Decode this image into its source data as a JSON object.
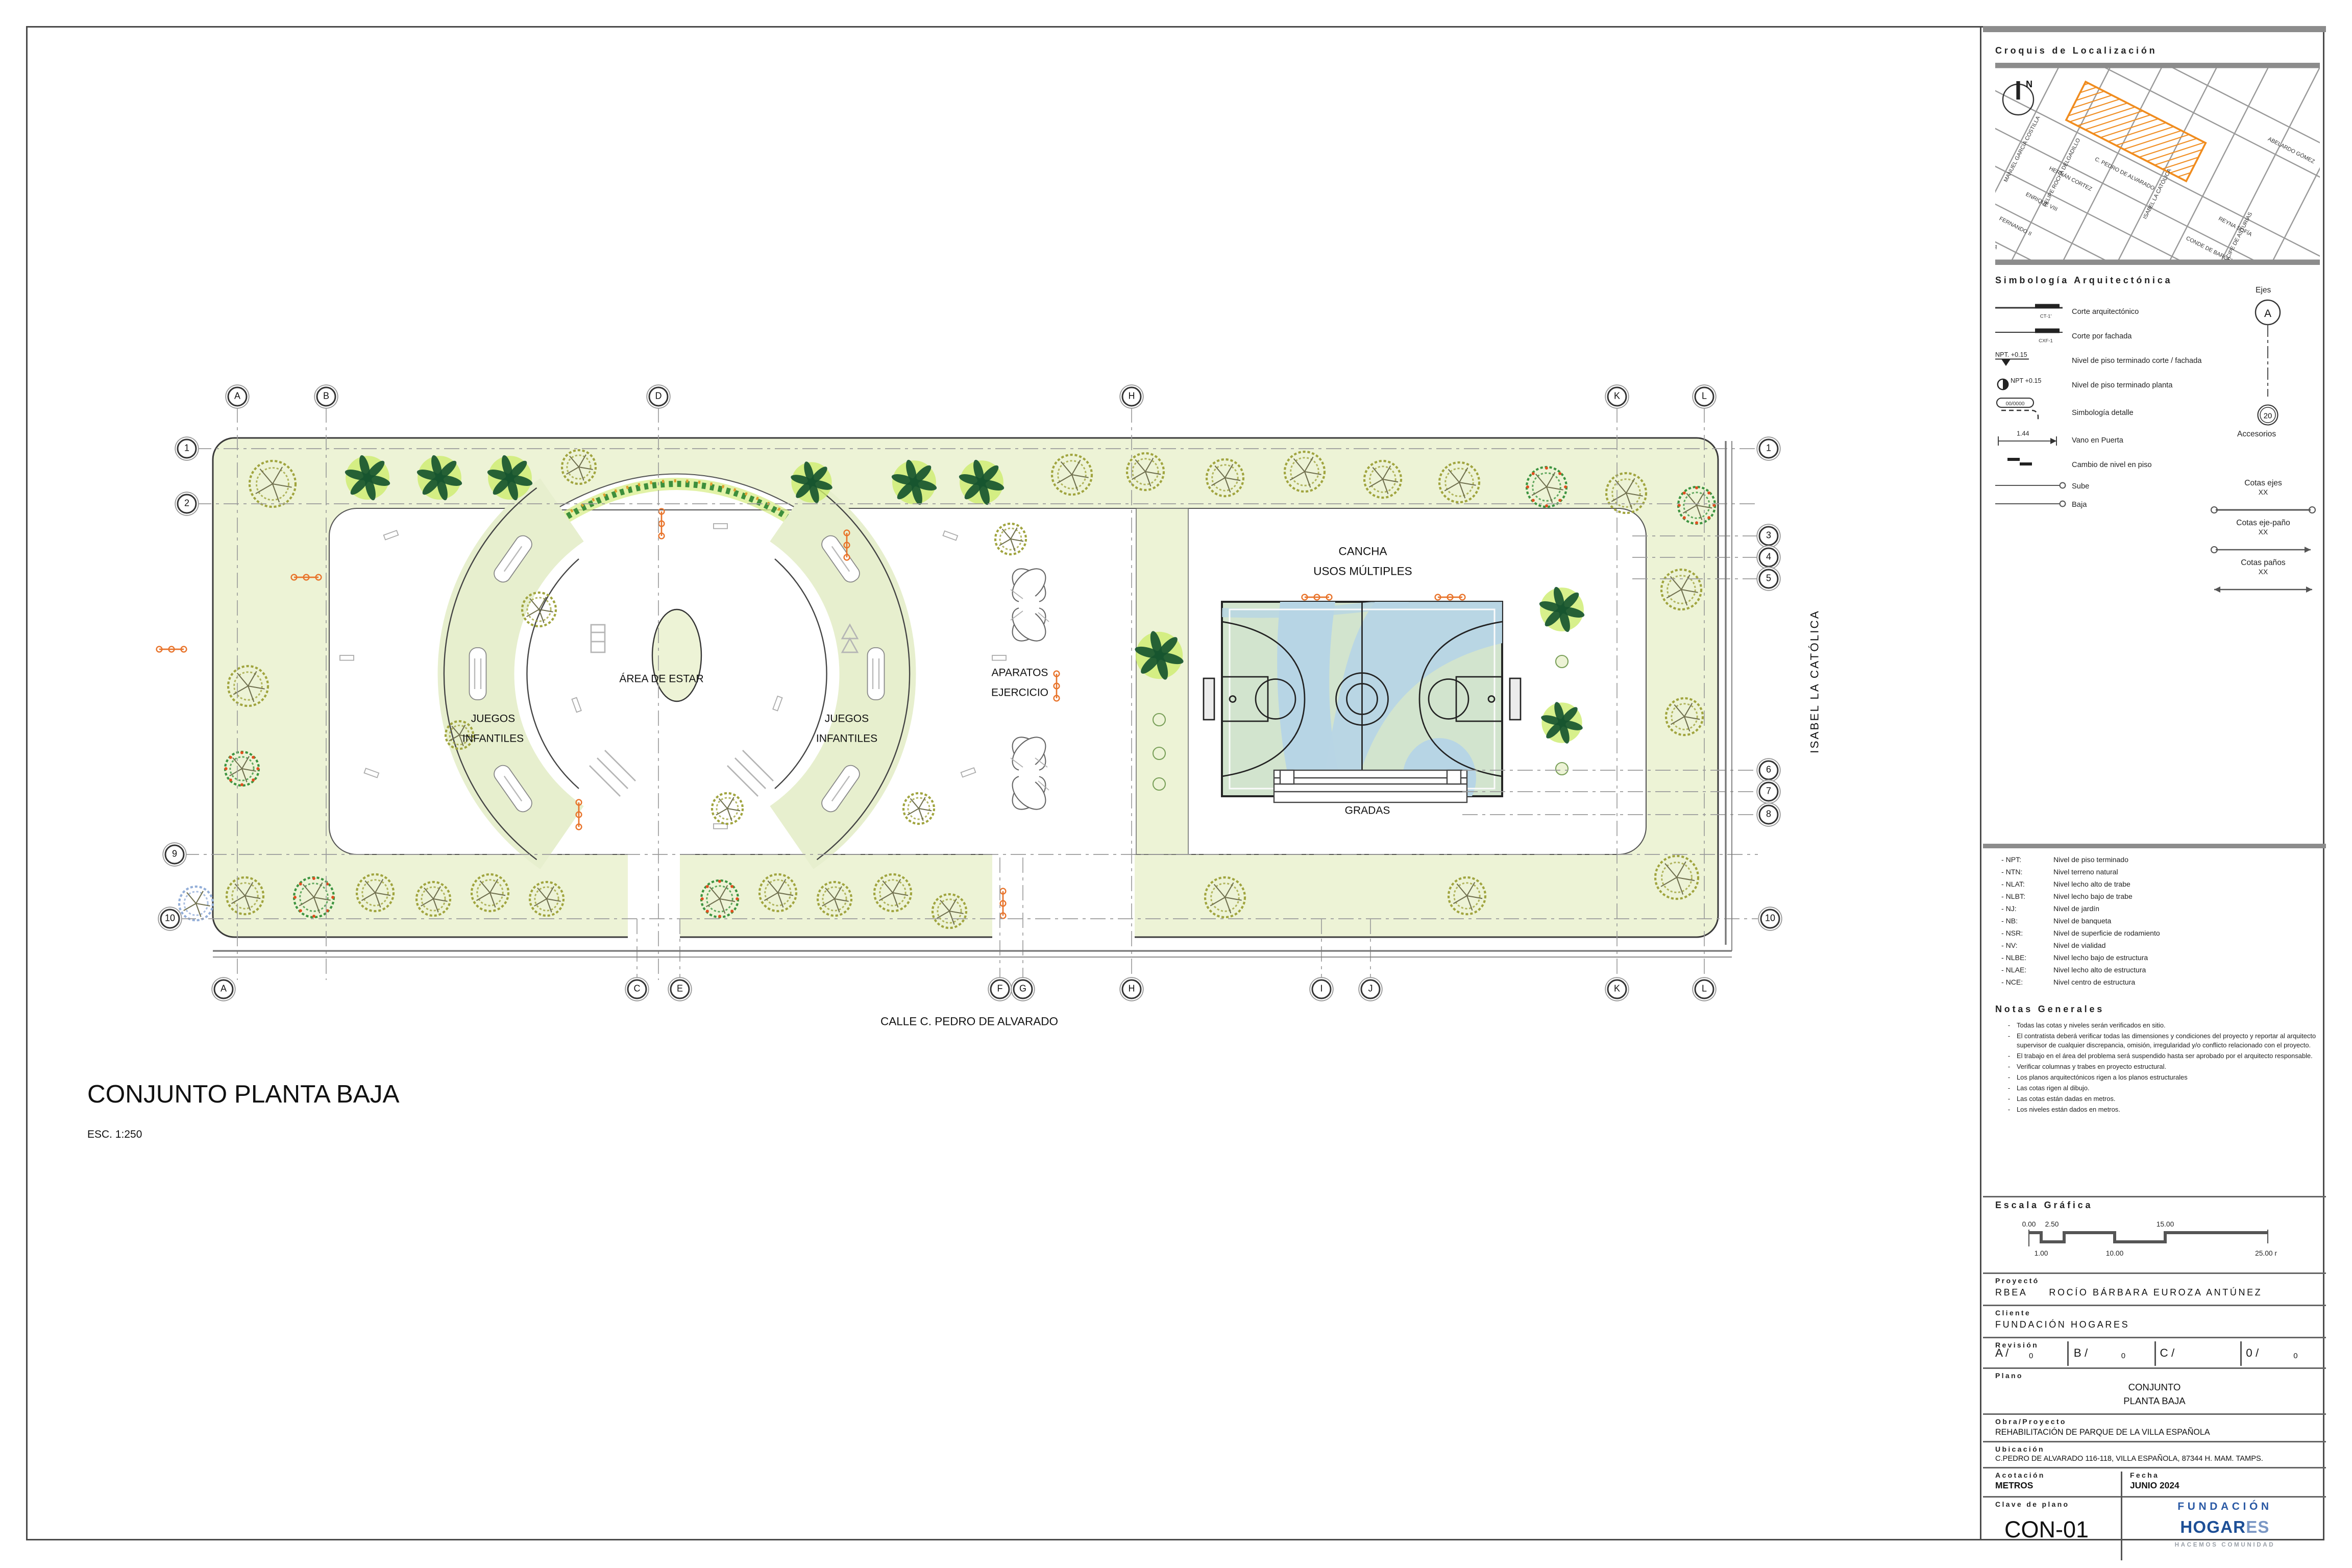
{
  "sheet": {
    "plan_title": "CONJUNTO PLANTA BAJA",
    "plan_scale": "ESC. 1:250",
    "street_bottom": "CALLE C. PEDRO DE ALVARADO",
    "street_right": "ISABEL LA CATÓLICA"
  },
  "plan_labels": {
    "cancha_line1": "CANCHA",
    "cancha_line2": "USOS MÚLTIPLES",
    "area_estar": "ÁREA DE ESTAR",
    "juegos_line1": "JUEGOS",
    "juegos_line2": "INFANTILES",
    "aparatos_line1": "APARATOS",
    "aparatos_line2": "EJERCICIO",
    "gradas": "GRADAS"
  },
  "axes": {
    "top": [
      "A",
      "B",
      "D",
      "H",
      "K",
      "L"
    ],
    "bottom": [
      "A",
      "C",
      "E",
      "F",
      "G",
      "H",
      "I",
      "J",
      "K",
      "L"
    ],
    "left": [
      "1",
      "2",
      "9",
      "10"
    ],
    "right": [
      "1",
      "3",
      "4",
      "5",
      "6",
      "7",
      "8",
      "10"
    ]
  },
  "titleblock": {
    "croquis_title": "Croquis de Localización",
    "north_label": "N",
    "map_streets": [
      "C. PEDRO DE ALVARADO",
      "HERNÁN CORTEZ",
      "ENRIQUE VIII",
      "FERNANDO II",
      "INFANTA ELENA",
      "REYNA SOFÍA",
      "CONDE DE BARCELONA",
      "ABELARDO GÓMEZ",
      "MANUEL GARCÍA COSTILLA",
      "FELIPE ROCHA DELGADILLO",
      "ISABEL LA CATÓLICA",
      "PRÍNCIPE DE ASTURIAS"
    ],
    "simbologia_title": "Simbología Arquitectónica",
    "symbols": [
      {
        "tag": "CT-1'",
        "label": "Corte arquitectónico"
      },
      {
        "tag": "CXF-1",
        "label": "Corte por fachada"
      },
      {
        "tag": "NPT. +0.15",
        "label": "Nivel de piso terminado corte / fachada"
      },
      {
        "tag": "NPT +0.15",
        "label": "Nivel de piso terminado planta"
      },
      {
        "tag": "00/0000",
        "label": "Simbología detalle"
      },
      {
        "tag": "1.44",
        "label": "Vano en Puerta"
      },
      {
        "tag": "",
        "label": "Cambio de nivel en piso"
      },
      {
        "tag": "",
        "label": "Sube"
      },
      {
        "tag": "",
        "label": "Baja"
      }
    ],
    "ejes_title": "Ejes",
    "ejes_bubble": "A",
    "accesorios_bubble": "20",
    "accesorios_label": "Accesorios",
    "cotas": [
      {
        "title": "Cotas ejes",
        "xx": "XX"
      },
      {
        "title": "Cotas eje-paño",
        "xx": "XX"
      },
      {
        "title": "Cotas paños",
        "xx": "XX"
      }
    ],
    "abbreviations": [
      {
        "abbr": "- NPT:",
        "def": "Nivel de piso terminado"
      },
      {
        "abbr": "- NTN:",
        "def": "Nivel terreno natural"
      },
      {
        "abbr": "- NLAT:",
        "def": "Nivel lecho alto de trabe"
      },
      {
        "abbr": "- NLBT:",
        "def": "Nivel lecho bajo de trabe"
      },
      {
        "abbr": "- NJ:",
        "def": "Nivel de jardín"
      },
      {
        "abbr": "- NB:",
        "def": "Nivel de banqueta"
      },
      {
        "abbr": "- NSR:",
        "def": "Nivel de superficie de rodamiento"
      },
      {
        "abbr": "- NV:",
        "def": "Nivel de vialidad"
      },
      {
        "abbr": "- NLBE:",
        "def": "Nivel lecho bajo de estructura"
      },
      {
        "abbr": "- NLAE:",
        "def": "Nivel lecho alto de estructura"
      },
      {
        "abbr": "- NCE:",
        "def": "Nivel centro de estructura"
      }
    ],
    "notas_title": "Notas Generales",
    "notas": [
      "Todas las cotas y niveles serán verificados en sitio.",
      "El contratista deberá verificar todas las dimensiones  y condiciones del proyecto y reportar al arquitecto supervisor de cualquier discrepancia, omisión, irregularidad y/o conflicto relacionado con el proyecto.",
      "El trabajo en el  área del problema será suspendido hasta ser aprobado por el arquitecto responsable.",
      "Verificar columnas y trabes en proyecto estructural.",
      "Los planos arquitectónicos rigen a los planos estructurales",
      "Las cotas rigen al dibujo.",
      "Las cotas están dadas en metros.",
      "Los niveles están dados en metros."
    ],
    "escala_title": "Escala Gráfica",
    "escala_top": [
      "0.00",
      "2.50",
      "15.00"
    ],
    "escala_bottom": [
      "1.00",
      "10.00",
      "25.00 m"
    ],
    "proyecto_label": "Proyectó",
    "proyecto_code": "RBEA",
    "proyecto_name": "ROCÍO BÁRBARA EUROZA ANTÚNEZ",
    "cliente_label": "Cliente",
    "cliente_value": "FUNDACIÓN HOGARES",
    "revision_label": "Revisión",
    "revision_cells": [
      {
        "k": "A /",
        "v": "0"
      },
      {
        "k": "B /",
        "v": "0"
      },
      {
        "k": "C /",
        "v": ""
      },
      {
        "k": "0 /",
        "v": "0"
      }
    ],
    "plano_label": "Plano",
    "plano_line1": "CONJUNTO",
    "plano_line2": "PLANTA BAJA",
    "obra_label": "Obra/Proyecto",
    "obra_value": "REHABILITACIÓN DE PARQUE DE LA VILLA ESPAÑOLA",
    "ubicacion_label": "Ubicación",
    "ubicacion_value": "C.PEDRO DE ALVARADO 116-118, VILLA ESPAÑOLA, 87344 H. MAM. TAMPS.",
    "acotacion_label": "Acotación",
    "acotacion_value": "METROS",
    "fecha_label": "Fecha",
    "fecha_value": "JUNIO 2024",
    "clave_label": "Clave de plano",
    "clave_value": "CON-01",
    "logo_line1": "FUNDACIÓN",
    "logo_line2a": "HOGAR",
    "logo_line2b": "ES",
    "logo_tagline": "HACEMOS COMUNIDAD"
  },
  "colors": {
    "lawn": "#edf3d6",
    "court_green": "#d2e4ce",
    "court_blue": "#b7d5e5",
    "palm": "#17552f",
    "palm_halo": "#cdec6e",
    "olive": "#a0a43e",
    "twig": "#70704f",
    "flower": "#3d9440",
    "berry": "#e05020",
    "bluetree": "#93aed8",
    "lamp_orange": "#e8732a",
    "parcel_orange": "#f08c1e",
    "line_dark": "#3a3a3a"
  }
}
